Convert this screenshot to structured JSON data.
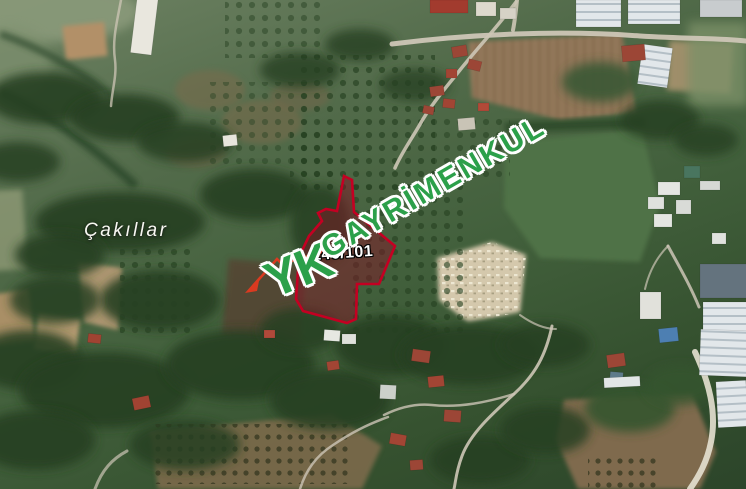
{
  "map": {
    "type": "satellite-imagery",
    "place_label": "Çakıllar",
    "parcel_label": "146/101",
    "watermark": {
      "logo": "YK",
      "brand": "GAYRİMENKUL"
    },
    "colors": {
      "parcel_outline": "#c40022",
      "parcel_fill": "rgba(138,16,38,0.45)",
      "watermark_green": "#2ca04a",
      "label_white": "#ffffff",
      "roofline_red": "#da3a20"
    }
  }
}
